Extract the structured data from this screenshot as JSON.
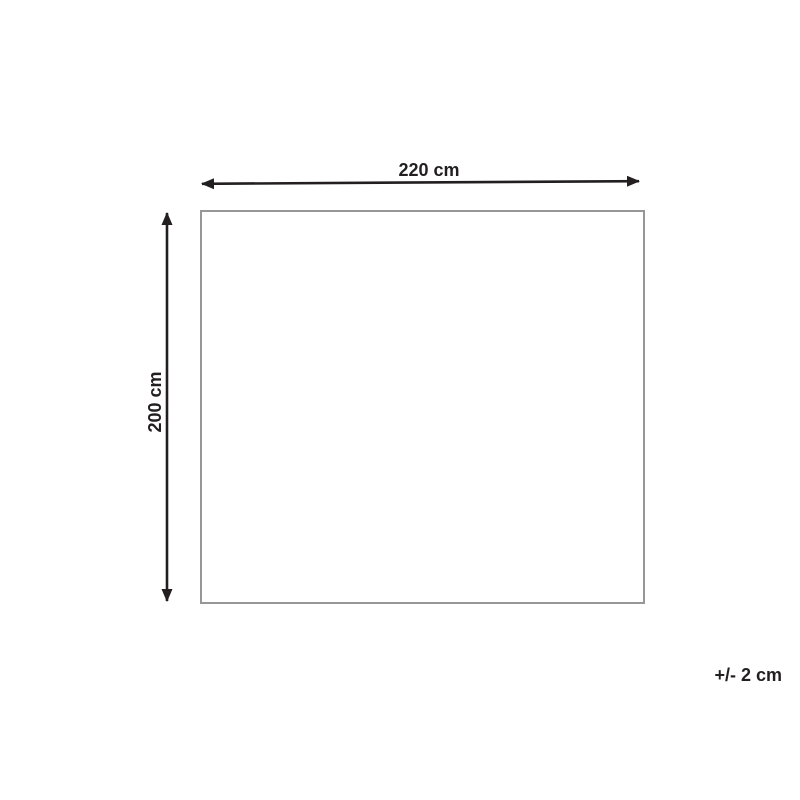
{
  "diagram": {
    "width_label": "220 cm",
    "height_label": "200 cm",
    "tolerance_label": "+/- 2 cm",
    "icons": {
      "width_arrow": "double-headed-horizontal-arrow",
      "height_arrow": "double-headed-vertical-arrow"
    },
    "colors": {
      "arrow": "#231f20",
      "text": "#231f20",
      "outline": "#979797",
      "background": "#ffffff"
    }
  }
}
